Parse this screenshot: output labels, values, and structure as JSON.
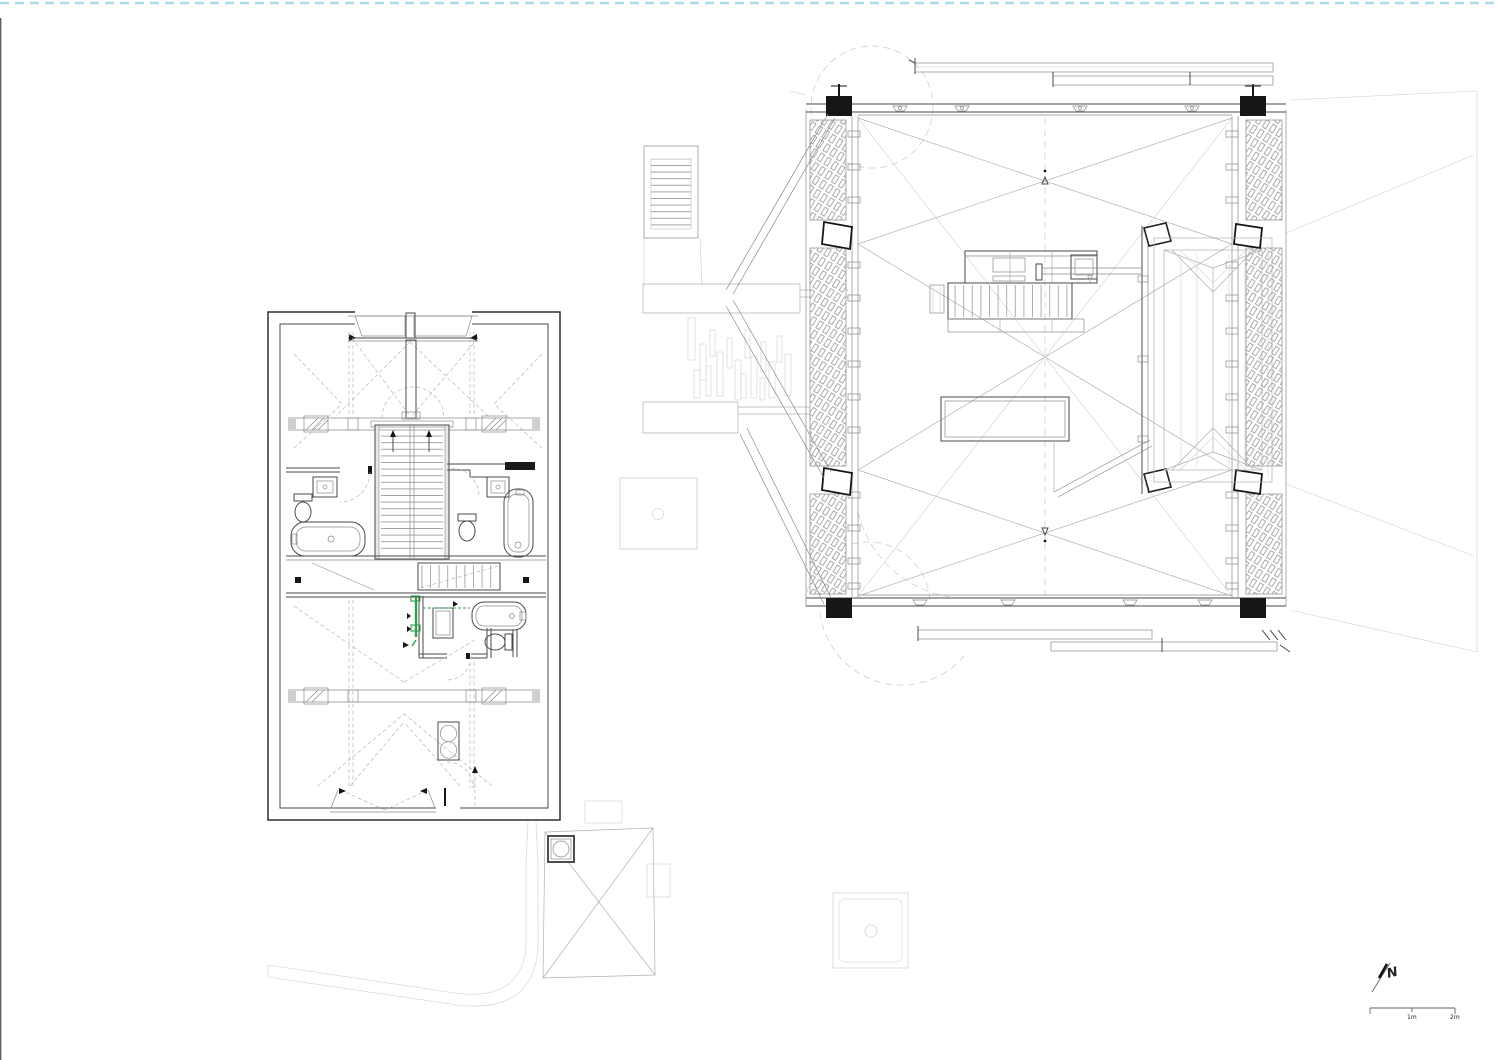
{
  "annotations": {
    "north_arrow": {
      "label": "N"
    },
    "scale_bar": {
      "tick_labels": [
        "1m",
        "2m"
      ]
    }
  },
  "colors": {
    "paper": "#ffffff",
    "page_edge_dash": "#aadcec",
    "ink_dark": "#2f2f2f",
    "line_mid": "#8a8a8a",
    "line_light": "#b0b0b0",
    "line_faint": "#c9c9c9",
    "hatch": "#a4a4a4",
    "accent_green": "#2fa14b",
    "post_black": "#161616"
  }
}
